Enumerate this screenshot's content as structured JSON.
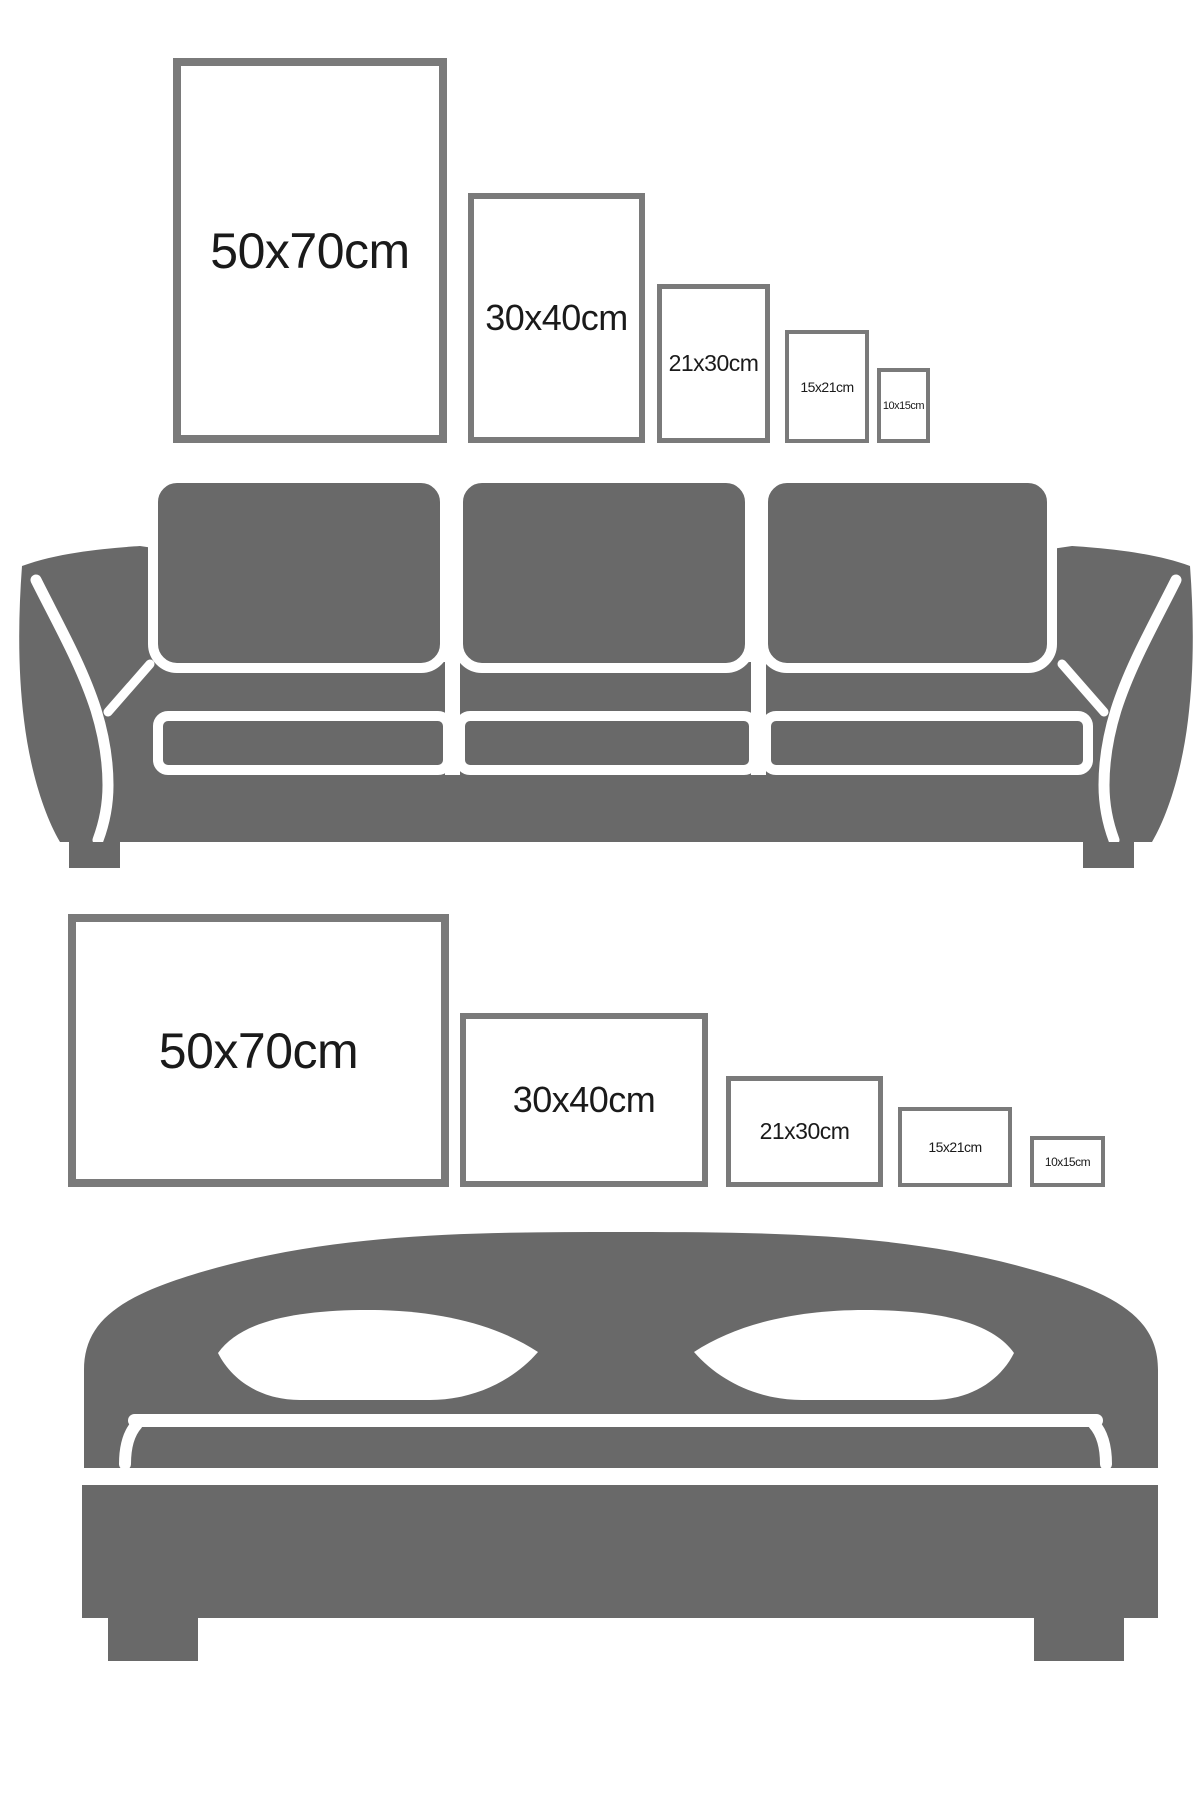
{
  "colors": {
    "furniture": "#696969",
    "frame_border": "#7a7a7a",
    "label_text": "#1a1a1a",
    "background": "#ffffff"
  },
  "top_section": {
    "name": "portrait-frame-sizes-above-sofa",
    "furniture_icon": "sofa-icon",
    "frame_orientation": "portrait",
    "frames": [
      {
        "label": "50x70cm"
      },
      {
        "label": "30x40cm"
      },
      {
        "label": "21x30cm"
      },
      {
        "label": "15x21cm"
      },
      {
        "label": "10x15cm"
      }
    ]
  },
  "bottom_section": {
    "name": "landscape-frame-sizes-above-bed",
    "furniture_icon": "bed-icon",
    "frame_orientation": "landscape",
    "frames": [
      {
        "label": "50x70cm"
      },
      {
        "label": "30x40cm"
      },
      {
        "label": "21x30cm"
      },
      {
        "label": "15x21cm"
      },
      {
        "label": "10x15cm"
      }
    ]
  }
}
